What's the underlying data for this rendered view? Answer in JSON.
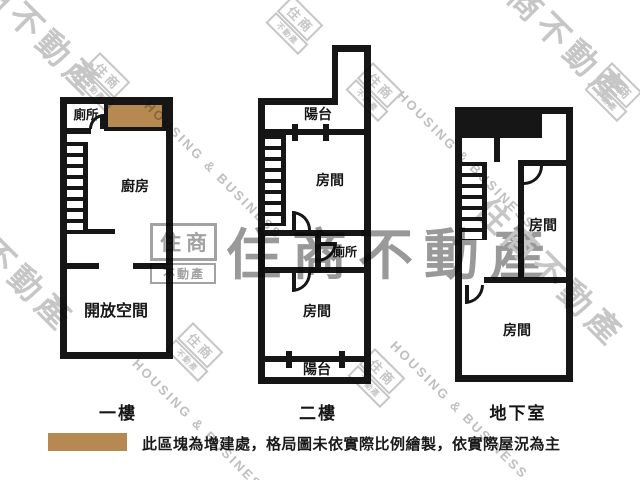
{
  "colors": {
    "wall": "#161616",
    "addition_block": "#b5894f",
    "watermark_light": "#c6c6c6",
    "watermark_dark": "#9a9a9a"
  },
  "floors": [
    {
      "label": "一樓",
      "rooms": {
        "toilet": "廁所",
        "kitchen": "廚房",
        "open_space": "開放空間"
      }
    },
    {
      "label": "二樓",
      "rooms": {
        "balcony_top": "陽台",
        "room_upper": "房間",
        "toilet": "廁所",
        "room_lower": "房間",
        "balcony_bottom": "陽台"
      }
    },
    {
      "label": "地下室",
      "rooms": {
        "room_upper": "房間",
        "room_lower": "房間"
      }
    }
  ],
  "legend": {
    "note": "此區塊為增建處，格局圖未依實際比例繪製，依實際屋況為主"
  },
  "watermark": {
    "brand": "住商不動產",
    "brand_line1": "住商",
    "brand_line2": "不動產",
    "tagline": "HOUSING & BUSINESS"
  }
}
